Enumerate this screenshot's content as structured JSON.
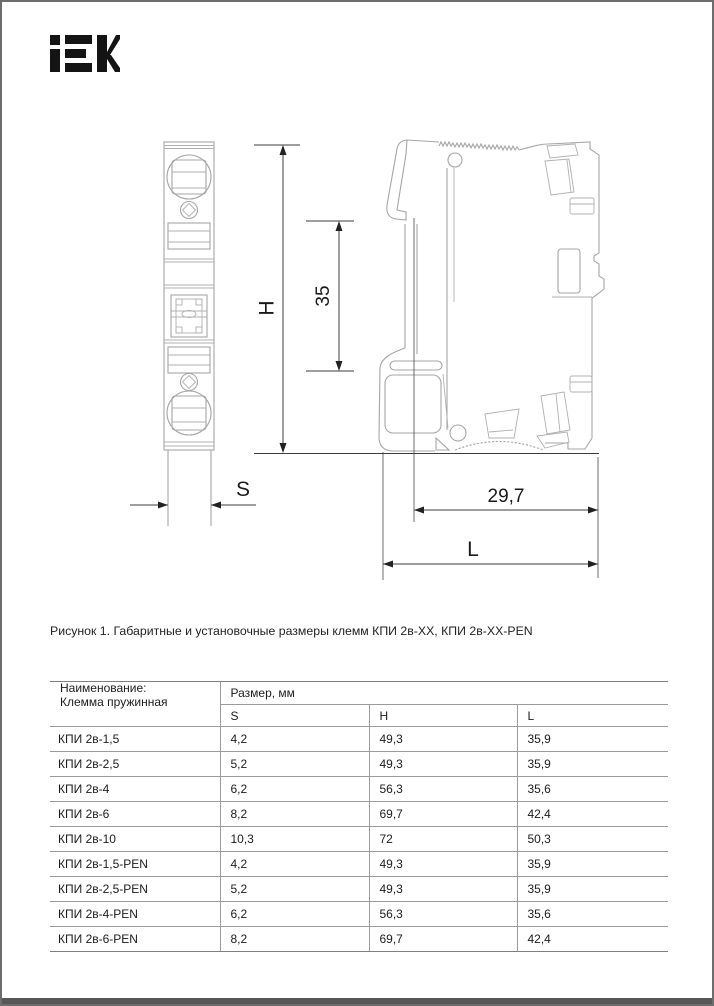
{
  "header": {
    "brand": "IEK"
  },
  "figure": {
    "caption": "Рисунок 1. Габаритные и установочные размеры клемм КПИ 2в-ХХ, КПИ 2в-ХХ-PEN",
    "dim_labels": {
      "height": "H",
      "rail": "35",
      "width": "S",
      "mount_depth": "29,7",
      "length": "L"
    }
  },
  "table": {
    "name_header_line1": "Наименование:",
    "name_header_line2": "Клемма пружинная",
    "size_header": "Размер, мм",
    "columns": [
      "S",
      "H",
      "L"
    ],
    "rows": [
      {
        "name": "КПИ 2в-1,5",
        "s": "4,2",
        "h": "49,3",
        "l": "35,9"
      },
      {
        "name": "КПИ 2в-2,5",
        "s": "5,2",
        "h": "49,3",
        "l": "35,9"
      },
      {
        "name": "КПИ 2в-4",
        "s": "6,2",
        "h": "56,3",
        "l": "35,6"
      },
      {
        "name": "КПИ 2в-6",
        "s": "8,2",
        "h": "69,7",
        "l": "42,4"
      },
      {
        "name": "КПИ 2в-10",
        "s": "10,3",
        "h": "72",
        "l": "50,3"
      },
      {
        "name": "КПИ 2в-1,5-PEN",
        "s": "4,2",
        "h": "49,3",
        "l": "35,9"
      },
      {
        "name": "КПИ 2в-2,5-PEN",
        "s": "5,2",
        "h": "49,3",
        "l": "35,9"
      },
      {
        "name": "КПИ 2в-4-PEN",
        "s": "6,2",
        "h": "56,3",
        "l": "35,6"
      },
      {
        "name": "КПИ 2в-6-PEN",
        "s": "8,2",
        "h": "69,7",
        "l": "42,4"
      }
    ]
  },
  "colors": {
    "frame": "#6d6d6d",
    "accent_bar": "#575757",
    "drawing_line": "#a6a6a6",
    "dimension_line": "#3c3c3c"
  }
}
